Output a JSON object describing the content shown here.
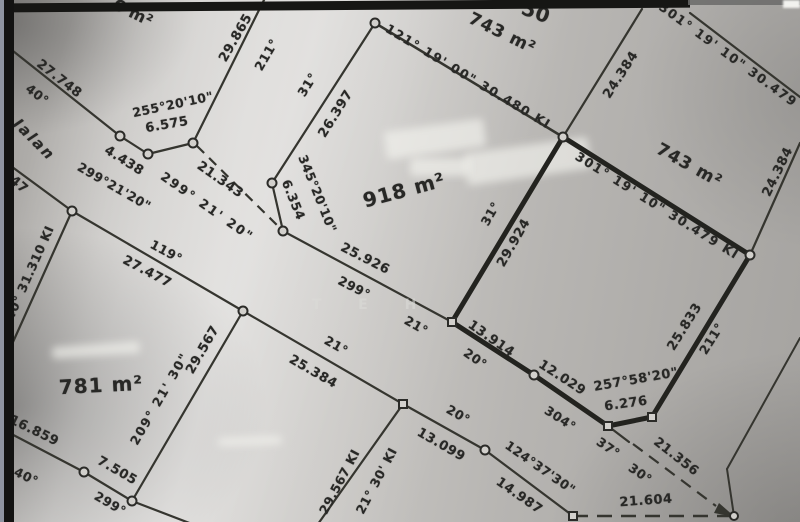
{
  "map": {
    "description": "Scanned cadastral survey plan with land parcels, bearings and distances",
    "watermark": "T E H",
    "road_name": "Jalan",
    "parcel_areas": [
      "6 m²",
      "743 m²",
      "743 m²",
      "918 m²",
      "781 m²"
    ],
    "labels": [
      {
        "name": "area-partial-top-left",
        "text": "6 m²"
      },
      {
        "name": "distance",
        "text": "27.748"
      },
      {
        "name": "bearing",
        "text": "40°"
      },
      {
        "name": "road-name",
        "text": "Jalan"
      },
      {
        "name": "bearing",
        "text": "255°20'10\""
      },
      {
        "name": "distance",
        "text": "6.575"
      },
      {
        "name": "distance",
        "text": "29.865"
      },
      {
        "name": "bearing",
        "text": "211°"
      },
      {
        "name": "distance",
        "text": "4.438"
      },
      {
        "name": "bearing",
        "text": "299°21'20\""
      },
      {
        "name": "distance",
        "text": "21.343"
      },
      {
        "name": "bearing",
        "text": "299° 21' 20\""
      },
      {
        "name": "distance-partial",
        "text": "747"
      },
      {
        "name": "bearing",
        "text": "119°"
      },
      {
        "name": "distance",
        "text": "27.477"
      },
      {
        "name": "bearing-distance",
        "text": "40° 31.310 KI"
      },
      {
        "name": "area",
        "text": "918 m²"
      },
      {
        "name": "bearing",
        "text": "345°20'10\""
      },
      {
        "name": "distance",
        "text": "6.354"
      },
      {
        "name": "distance",
        "text": "26.397"
      },
      {
        "name": "bearing",
        "text": "31°"
      },
      {
        "name": "bearing-distance",
        "text": "121° 19' 00\" 30.480 KI"
      },
      {
        "name": "area",
        "text": "743 m²"
      },
      {
        "name": "partial-number",
        "text": "50"
      },
      {
        "name": "bearing-distance",
        "text": "301° 19' 10\" 30.479"
      },
      {
        "name": "distance",
        "text": "24.384"
      },
      {
        "name": "area",
        "text": "743 m²"
      },
      {
        "name": "distance",
        "text": "24.384"
      },
      {
        "name": "bearing-distance",
        "text": "301° 19' 10\" 30.479 KI"
      },
      {
        "name": "bearing",
        "text": "31°"
      },
      {
        "name": "distance",
        "text": "29.924"
      },
      {
        "name": "distance",
        "text": "25.926"
      },
      {
        "name": "bearing",
        "text": "299°"
      },
      {
        "name": "bearing",
        "text": "21°"
      },
      {
        "name": "distance",
        "text": "25.384"
      },
      {
        "name": "bearing",
        "text": "21°"
      },
      {
        "name": "distance",
        "text": "13.914"
      },
      {
        "name": "bearing",
        "text": "20°"
      },
      {
        "name": "bearing",
        "text": "20°"
      },
      {
        "name": "distance",
        "text": "13.099"
      },
      {
        "name": "bearing",
        "text": "124°37'30\""
      },
      {
        "name": "distance",
        "text": "14.987"
      },
      {
        "name": "distance",
        "text": "12.029"
      },
      {
        "name": "bearing",
        "text": "304°"
      },
      {
        "name": "bearing",
        "text": "257°58'20\""
      },
      {
        "name": "distance",
        "text": "6.276"
      },
      {
        "name": "distance",
        "text": "25.833"
      },
      {
        "name": "bearing",
        "text": "211°"
      },
      {
        "name": "bearing",
        "text": "37°"
      },
      {
        "name": "distance",
        "text": "21.356"
      },
      {
        "name": "bearing",
        "text": "30°"
      },
      {
        "name": "distance",
        "text": "21.604"
      },
      {
        "name": "area",
        "text": "781 m²"
      },
      {
        "name": "bearing",
        "text": "209° 21' 30\""
      },
      {
        "name": "distance",
        "text": "29.567"
      },
      {
        "name": "distance",
        "text": "16.859"
      },
      {
        "name": "bearing",
        "text": "40°"
      },
      {
        "name": "distance",
        "text": "7.505"
      },
      {
        "name": "bearing",
        "text": "299°"
      },
      {
        "name": "distance",
        "text": "29.567 KI"
      },
      {
        "name": "bearing",
        "text": "21° 30' KI"
      },
      {
        "name": "watermark",
        "text": "T E H"
      }
    ]
  }
}
